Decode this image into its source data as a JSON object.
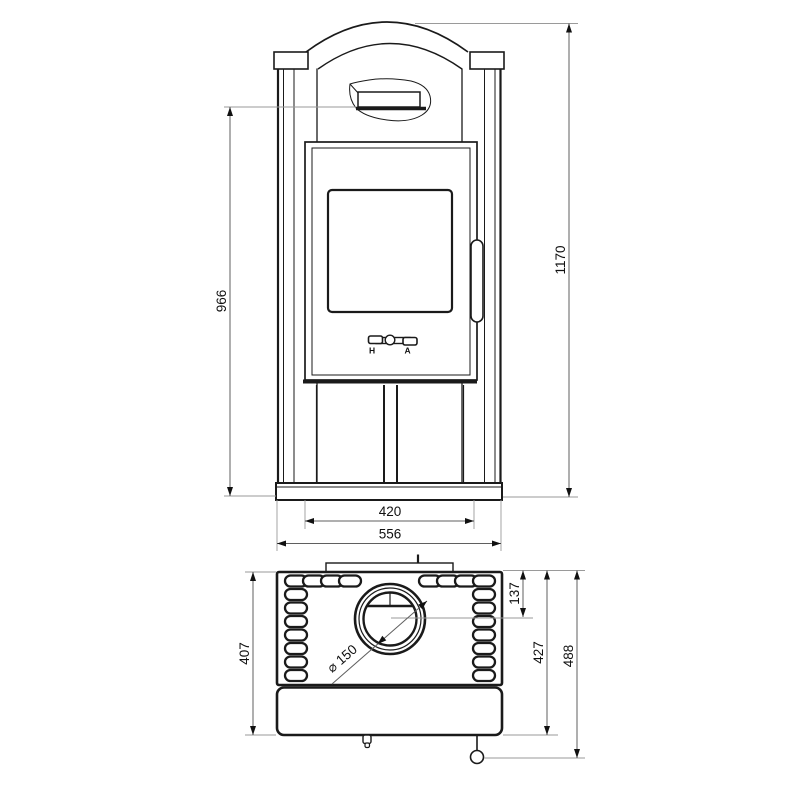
{
  "front_view": {
    "dim_height_total": "1170",
    "dim_height_to_shelf": "966",
    "dim_width_inner": "420",
    "dim_width_base": "556",
    "lever_left": "H",
    "lever_right": "A"
  },
  "top_view": {
    "dim_depth_body": "407",
    "dim_flue_center": "137",
    "dim_depth_front": "427",
    "dim_depth_overall": "488",
    "dim_flue_diameter": "⌀ 150"
  }
}
